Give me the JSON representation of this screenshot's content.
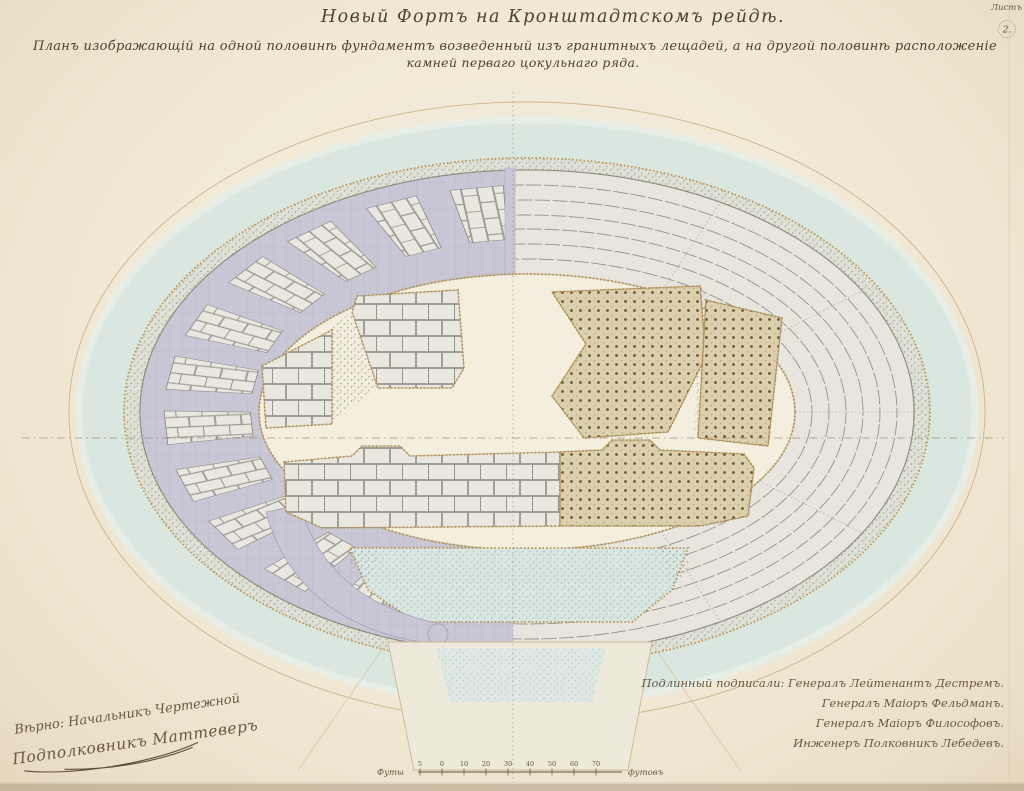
{
  "document": {
    "title": "Новый Фортъ на Кронштадтскомъ рейдѣ.",
    "subtitle_line1": "Планъ изображающій на одной половинѣ фундаментъ возведенный изъ гранитныхъ лещадей, а на другой половинѣ расположеніе",
    "subtitle_line2": "камней перваго цокульнаго ряда.",
    "corner_note": "Листъ",
    "page_mark": "2."
  },
  "signatures": {
    "right": [
      "Подлинный подписали: Генералъ Лейтенантъ Дестремъ.",
      "Генералъ Маіоръ Фельдманъ.",
      "Генералъ Маіоръ Философовъ.",
      "Инженеръ Полковникъ Лебедевъ."
    ],
    "left_line1": "Вѣрно: Начальникъ Чертежной",
    "left_line2": "Подполковникъ Маттеверъ"
  },
  "scale_bar": {
    "left_label": "Футы",
    "right_label": "футовъ",
    "ticks": [
      "5",
      "0",
      "10",
      "20",
      "30",
      "40",
      "50",
      "60",
      "70"
    ]
  },
  "colors": {
    "paper": "#f1e9d6",
    "water": "#dae6e0",
    "rubble_band": "#e0e1d6",
    "masonry_lavender": "#c9c7d6",
    "stone_block": "#e9e7e0",
    "stone_joint": "#8d8c85",
    "gold_trim": "#bd9750",
    "dotted_platform": "#dccfad",
    "platform_dot": "#6b5633",
    "ink": "#4f4130",
    "signature_ink": "#6a5843"
  }
}
